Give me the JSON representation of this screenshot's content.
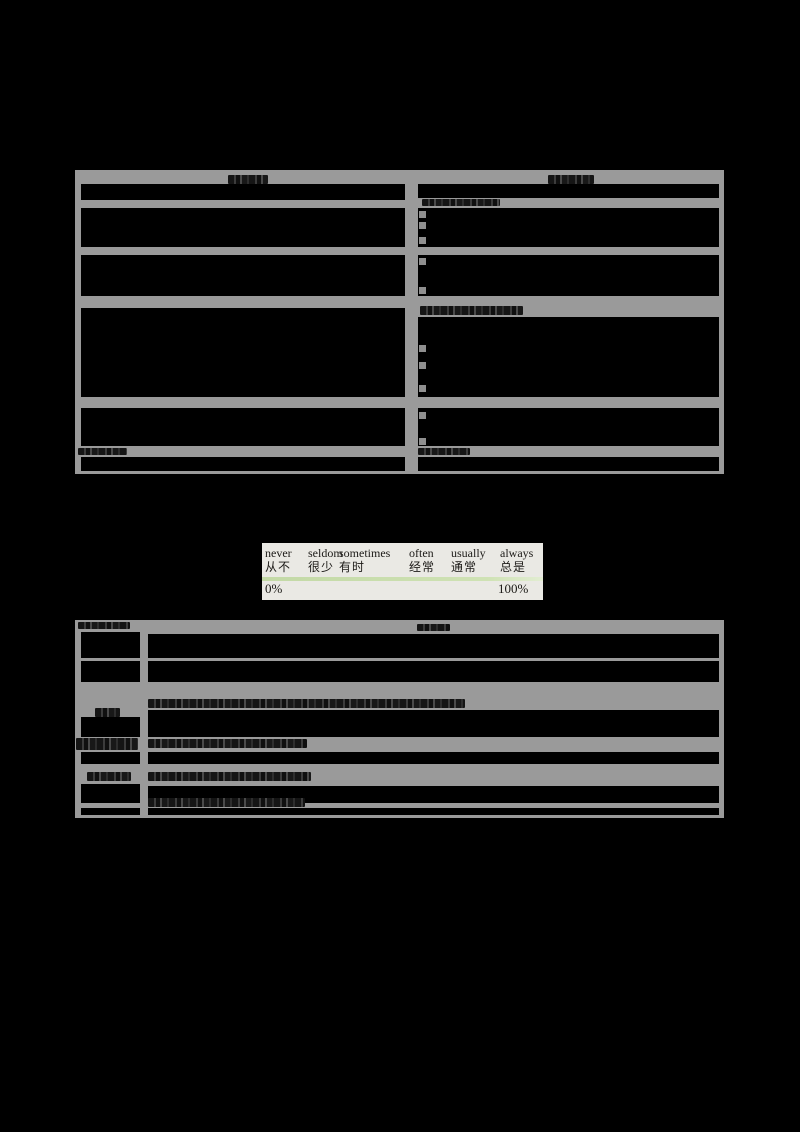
{
  "colors": {
    "page_bg": "#000000",
    "table_band_gray": "#9a9a9a",
    "cell_fill": "#000000",
    "panel_bg": "#eae9e4",
    "panel_text": "#1c1a17",
    "divider_green": "#cbdfae"
  },
  "frequency_scale": {
    "columns": [
      {
        "en": "never",
        "zh": "从不"
      },
      {
        "en": "seldom",
        "zh": "很少"
      },
      {
        "en": "sometimes",
        "zh": "有时"
      },
      {
        "en": "often",
        "zh": "经常"
      },
      {
        "en": "usually",
        "zh": "通常"
      },
      {
        "en": "always",
        "zh": "总是"
      }
    ],
    "min_label": "0%",
    "max_label": "100%"
  },
  "tables": {
    "top": {
      "columns": 2,
      "rows": 6,
      "legible_text": ""
    },
    "bottom": {
      "columns": 2,
      "rows": 6,
      "legible_text": ""
    }
  }
}
